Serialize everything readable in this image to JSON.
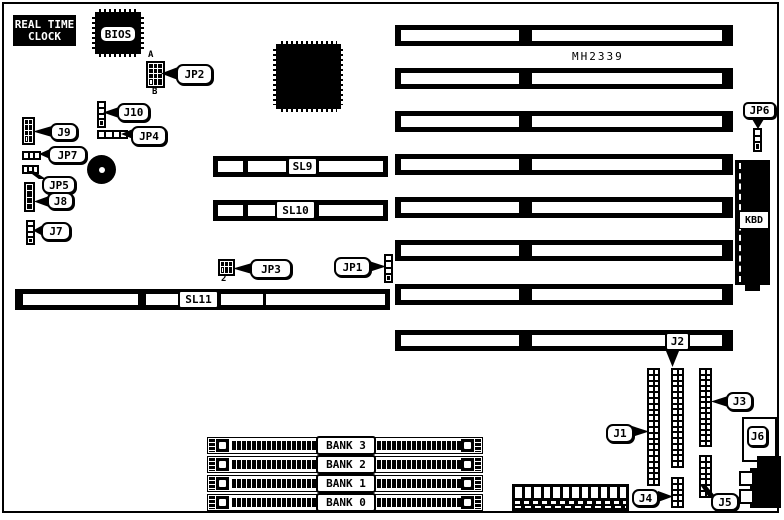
{
  "colors": {
    "ink": "#000000",
    "paper": "#ffffff"
  },
  "rtc": {
    "line1": "REAL TIME",
    "line2": "CLOCK"
  },
  "chips": {
    "bios": "BIOS",
    "part_number": "MH2339"
  },
  "callouts": {
    "jp1": "JP1",
    "jp2": "JP2",
    "jp3": "JP3",
    "jp4": "JP4",
    "jp5": "JP5",
    "jp6": "JP6",
    "jp7": "JP7",
    "j1": "J1",
    "j2": "J2",
    "j3": "J3",
    "j4": "J4",
    "j5": "J5",
    "j6": "J6",
    "j7": "J7",
    "j8": "J8",
    "j9": "J9",
    "j10": "J10"
  },
  "pin_markers": {
    "jp2_a": "A",
    "jp2_b": "B",
    "jp3_2": "2"
  },
  "slots": {
    "sl9": "SL9",
    "sl10": "SL10",
    "sl11": "SL11"
  },
  "kbd": "KBD",
  "banks": [
    "BANK 3",
    "BANK 2",
    "BANK 1",
    "BANK 0"
  ]
}
